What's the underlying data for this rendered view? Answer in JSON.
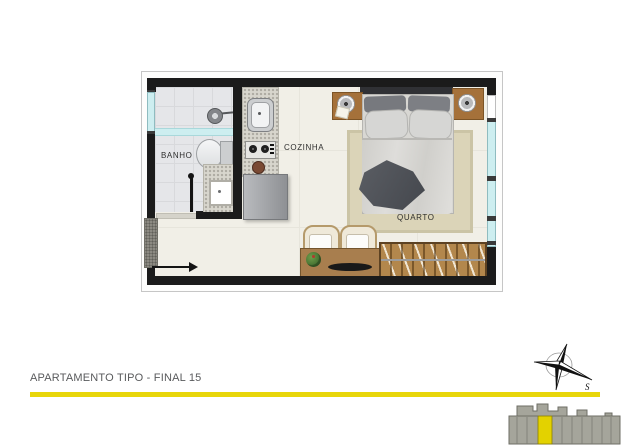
{
  "footer": {
    "title": "APARTAMENTO TIPO - FINAL 15"
  },
  "floorplan": {
    "rooms": [
      {
        "id": "banho",
        "label": "BANHO"
      },
      {
        "id": "cozinha",
        "label": "COZINHA"
      },
      {
        "id": "quarto",
        "label": "QUARTO"
      }
    ],
    "entrance_arrow_direction": "right",
    "colors": {
      "wall": "#1B1B1B",
      "floor": "#F1EFE7",
      "bath_floor": "#E5E6E9",
      "window_glass": "#CDEEF0",
      "granite": "#D8D6CD",
      "wood": "#A87E4E",
      "wardrobe_wood": "#B3874C",
      "rug": "#DBD4B8",
      "accent": "#E8D60A"
    }
  },
  "compass": {
    "label": "S"
  },
  "locator": {
    "type": "building-elevation",
    "building_color": "#A5A59B",
    "highlight_color": "#E3D200"
  }
}
